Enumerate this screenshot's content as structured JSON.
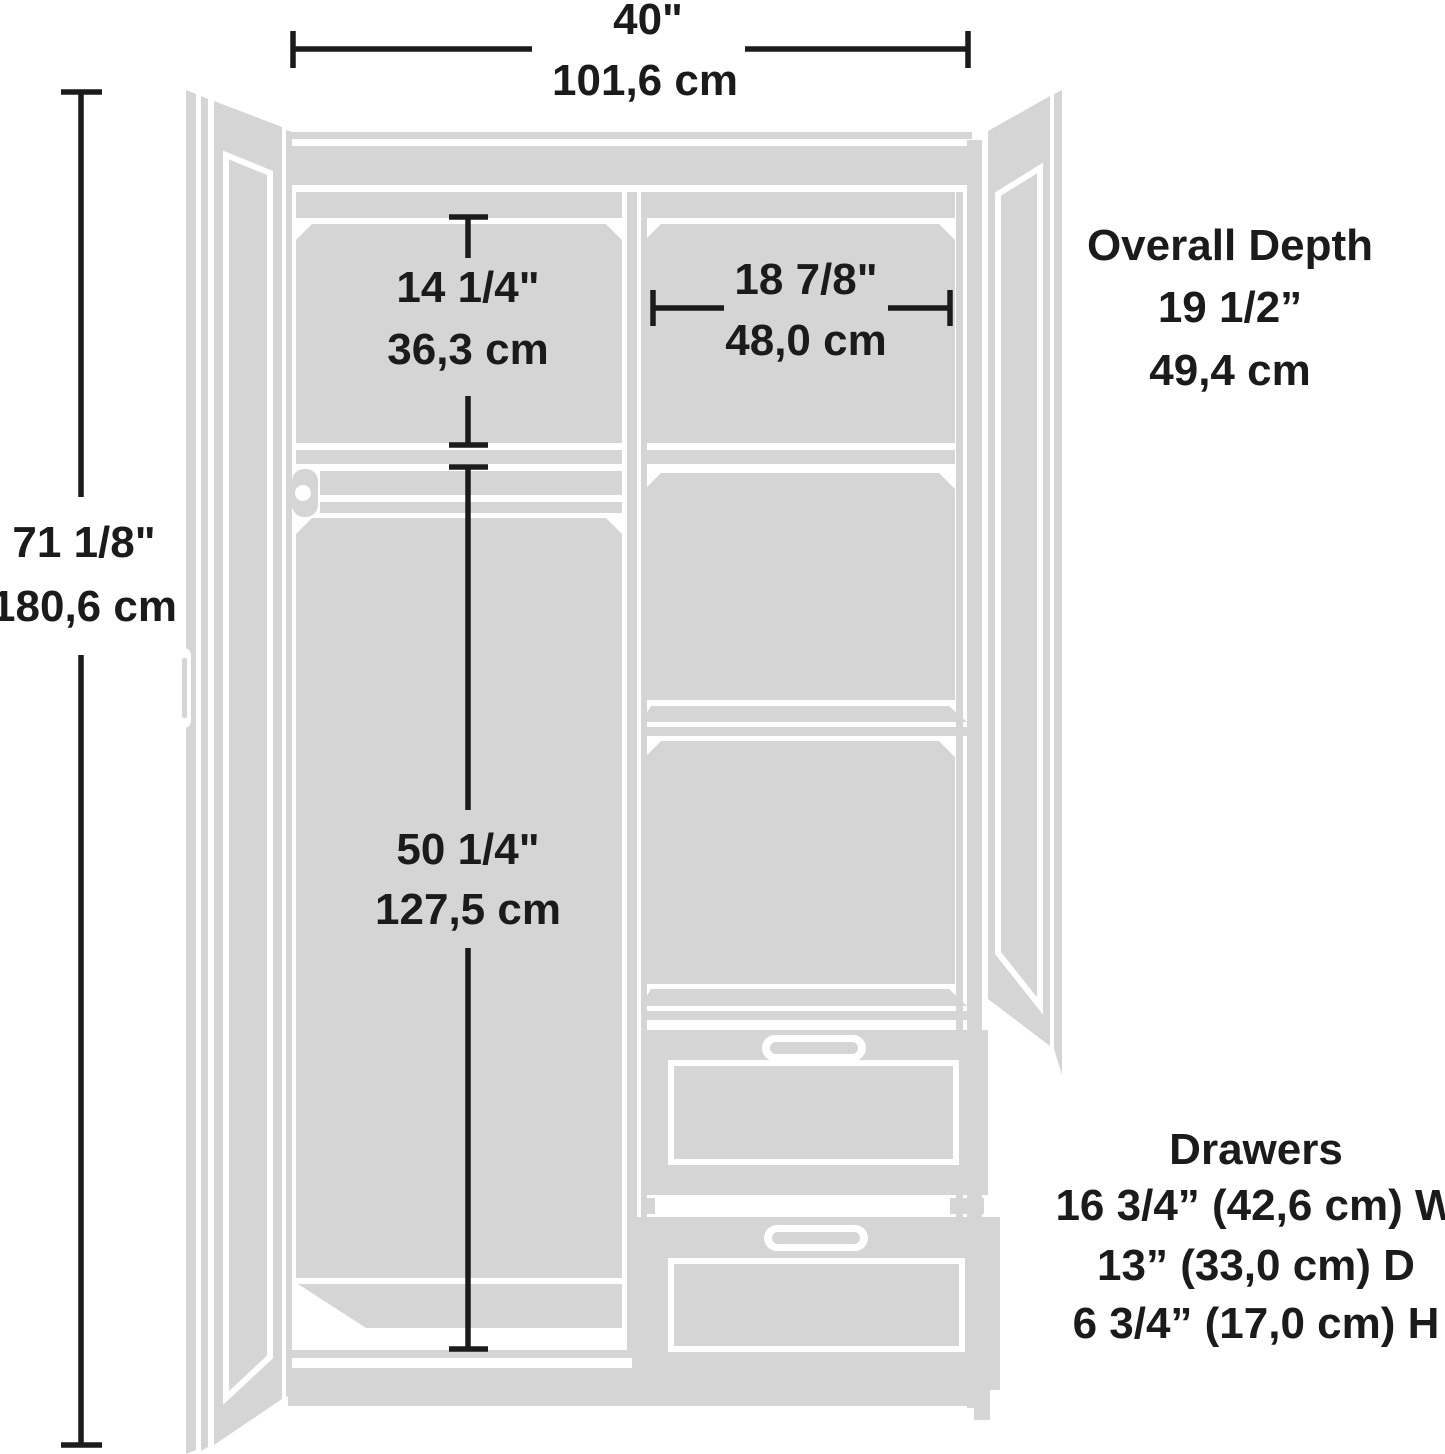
{
  "diagram": {
    "overall_width": {
      "inches": "40\"",
      "cm": "101,6 cm"
    },
    "overall_height": {
      "inches": "71 1/8\"",
      "cm": "180,6 cm"
    },
    "upper_left_compartment": {
      "inches": "14 1/4\"",
      "cm": "36,3 cm"
    },
    "upper_right_compartment": {
      "inches": "18 7/8\"",
      "cm": "48,0 cm"
    },
    "hanging_compartment": {
      "inches": "50 1/4\"",
      "cm": "127,5 cm"
    },
    "overall_depth": {
      "label": "Overall Depth",
      "inches": "19 1/2”",
      "cm": "49,4 cm"
    },
    "drawers": {
      "label": "Drawers",
      "width": "16 3/4” (42,6 cm) W",
      "depth": "13” (33,0 cm) D",
      "height": "6 3/4” (17,0 cm) H"
    }
  },
  "colors": {
    "panel": "#d5d5d5",
    "line": "#1b1b1b",
    "background": "#ffffff"
  }
}
